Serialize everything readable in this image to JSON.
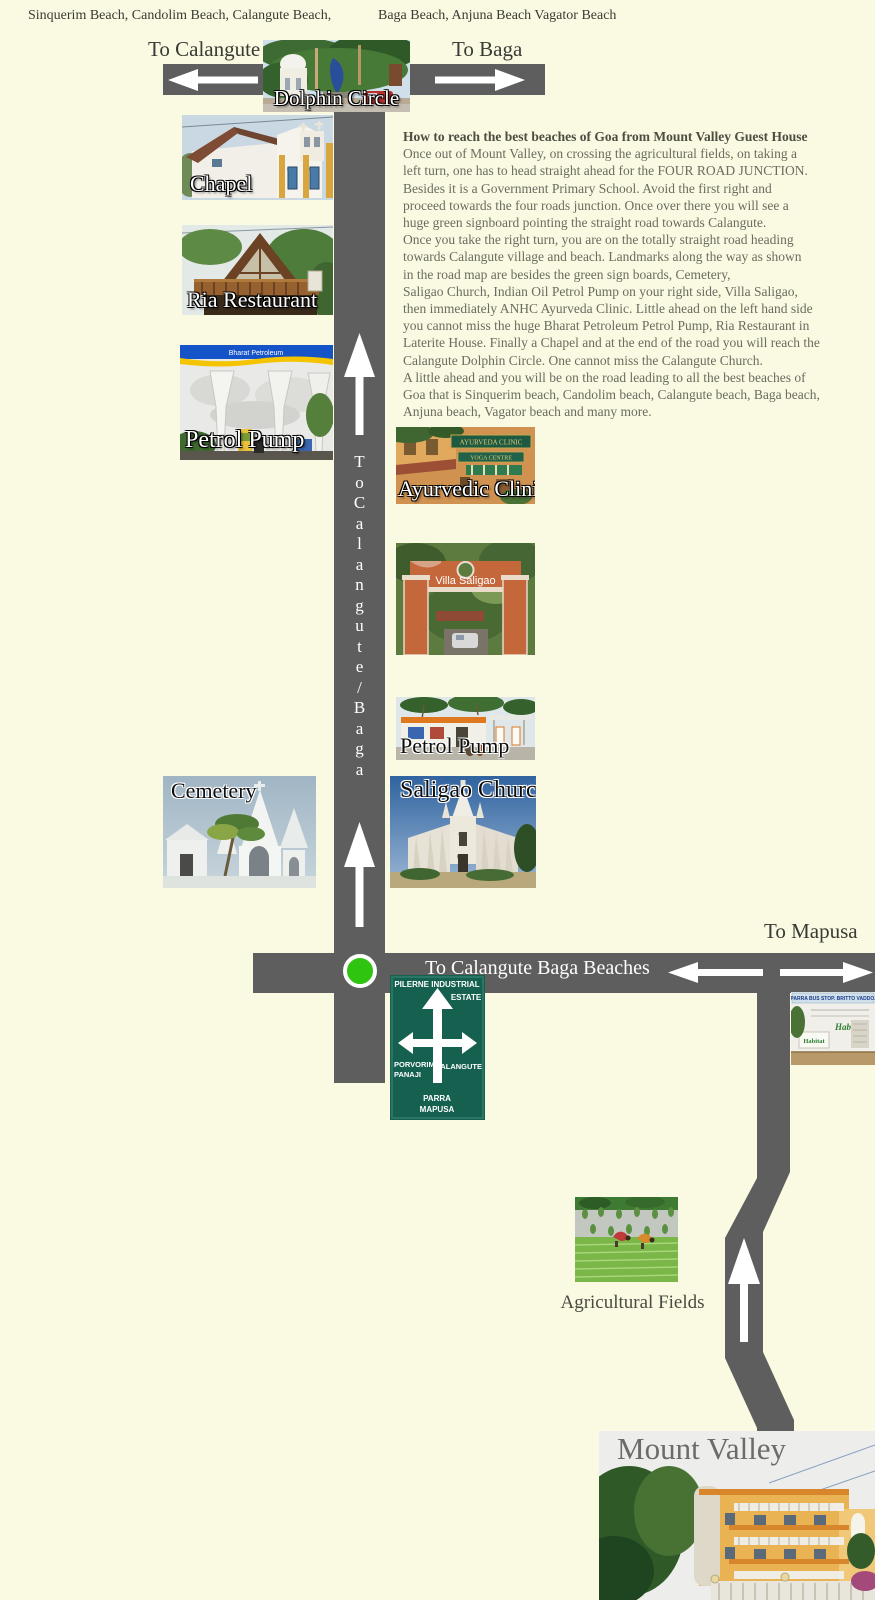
{
  "page": {
    "background": "#fafae3",
    "road_color": "#5e5e5e",
    "signal_green": "#2ec410"
  },
  "header": {
    "beaches_left": "Sinquerim Beach, Candolim Beach, Calangute Beach,",
    "beaches_right": "Baga Beach, Anjuna Beach Vagator Beach",
    "to_calangute": "To Calangute",
    "to_baga": "To Baga"
  },
  "description": {
    "title": "How to reach the best beaches of Goa from Mount Valley Guest House",
    "lines": [
      "Once out of Mount Valley, on crossing the agricultural fields, on taking a",
      "left turn, one has to head straight ahead for the FOUR ROAD JUNCTION.",
      "Besides it is a Government Primary School. Avoid the first right and",
      "proceed towards the four roads junction. Once over there you will see a",
      "huge green signboard pointing the straight road towards Calangute.",
      "Once you take the right turn, you are on the totally straight road heading",
      "towards Calangute village and beach. Landmarks along the way as shown",
      "in the road map are besides the green sign boards, Cemetery,",
      "Saligao Church, Indian Oil Petrol Pump on your right side, Villa Saligao,",
      "then immediately ANHC Ayurveda Clinic. Little ahead on the left hand side",
      "you cannot miss the huge Bharat Petroleum Petrol Pump, Ria Restaurant in",
      "Laterite House. Finally a Chapel and at the end of the road you will reach the",
      "Calangute Dolphin Circle. One cannot miss the Calangute Church.",
      "A little ahead and you will be on the road leading to all the best beaches of",
      "Goa that is Sinquerim beach, Candolim beach, Calangute beach, Baga beach,",
      "Anjuna beach, Vagator beach and many more."
    ]
  },
  "roads": {
    "vertical_label": "To Calangute / Baga",
    "vertical_letters": [
      "T",
      "o",
      "C",
      "a",
      "l",
      "a",
      "n",
      "g",
      "u",
      "t",
      "e",
      "/",
      "B",
      "a",
      "g",
      "a"
    ],
    "junction_label": "To Calangute Baga Beaches",
    "to_mapusa": "To Mapusa"
  },
  "landmarks": {
    "dolphin_circle": {
      "label": "Dolphin Circle"
    },
    "chapel": {
      "label": "Chapel"
    },
    "ria_restaurant": {
      "label": "Ria Restaurant"
    },
    "petrol_pump_bharat": {
      "label": "Petrol Pump",
      "brand": "Bharat Petroleum"
    },
    "ayurvedic_clinic": {
      "label": "Ayurvedic Clinic",
      "sign_line1": "AYURVEDA CLINIC",
      "sign_line2": "YOGA CENTRE"
    },
    "villa_saligao": {
      "label": "Villa Saligao",
      "gate_text": "Villa Saligao"
    },
    "petrol_pump_indian_oil": {
      "label": "Petrol Pump"
    },
    "saligao_church": {
      "label": "Saligao Church"
    },
    "cemetery": {
      "label": "Cemetery"
    },
    "agricultural_fields": {
      "label": "Agricultural Fields"
    },
    "mount_valley": {
      "label": "Mount Valley"
    },
    "bus_stop": {
      "header": "PARRA BUS STOP. BRITTO VADDO.",
      "sign": "Habitat"
    }
  },
  "green_signboard": {
    "top_line1": "PILERNE INDUSTRIAL",
    "top_line2": "ESTATE",
    "left_line1": "PORVORIM",
    "left_line2": "PANAJI",
    "right_line1": "CALANGUTE",
    "bottom_line1": "PARRA",
    "bottom_line2": "MAPUSA"
  }
}
